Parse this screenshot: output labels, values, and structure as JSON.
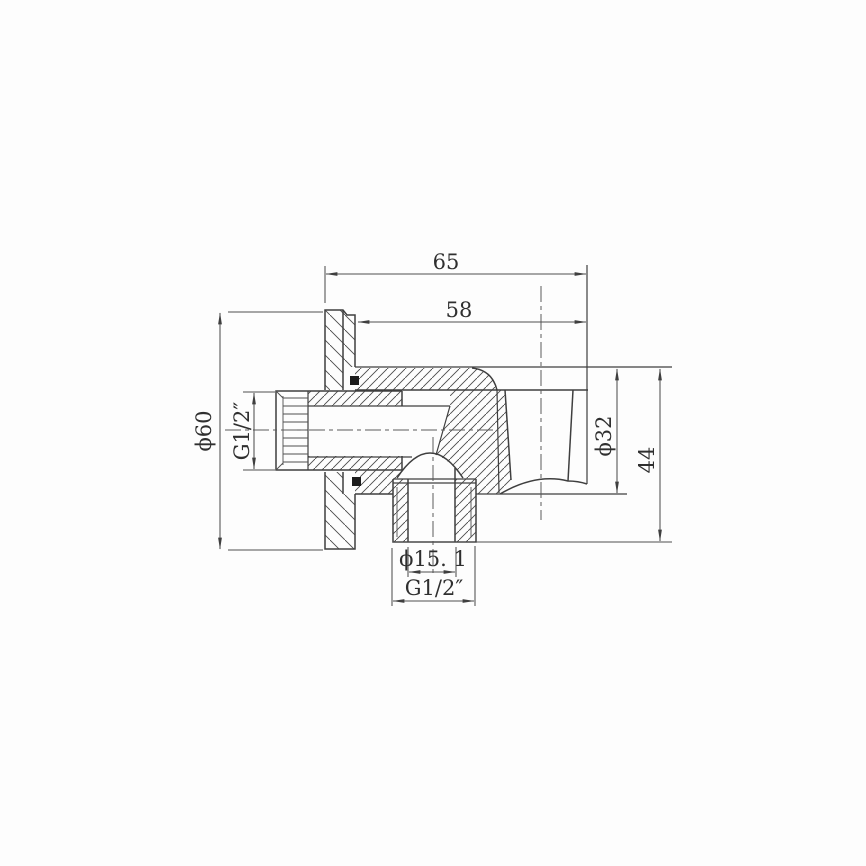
{
  "meta": {
    "background_color": "#fdfdfd",
    "line_color": "#3f3f3f",
    "text_color": "#2f2f2f"
  },
  "drawing": {
    "type": "technical-drawing",
    "description": "Sectional engineering drawing of a wall-mounted shower outlet elbow with hand-shower holder: wall flange, female threaded inlet, bottom threaded outlet and conical holder cup, with dimension lines",
    "dimensions": [
      {
        "id": "overall-depth",
        "label": "65",
        "orientation": "horizontal"
      },
      {
        "id": "body-depth",
        "label": "58",
        "orientation": "horizontal"
      },
      {
        "id": "flange-diameter",
        "label": "ϕ60",
        "orientation": "vertical"
      },
      {
        "id": "inlet-thread",
        "label": "G1/2″",
        "orientation": "vertical"
      },
      {
        "id": "holder-diameter",
        "label": "ϕ32",
        "orientation": "vertical"
      },
      {
        "id": "overall-height",
        "label": "44",
        "orientation": "vertical"
      },
      {
        "id": "outlet-bore-diameter",
        "label": "ϕ15. 1",
        "orientation": "horizontal"
      },
      {
        "id": "outlet-thread",
        "label": "G1/2″",
        "orientation": "horizontal"
      }
    ]
  }
}
